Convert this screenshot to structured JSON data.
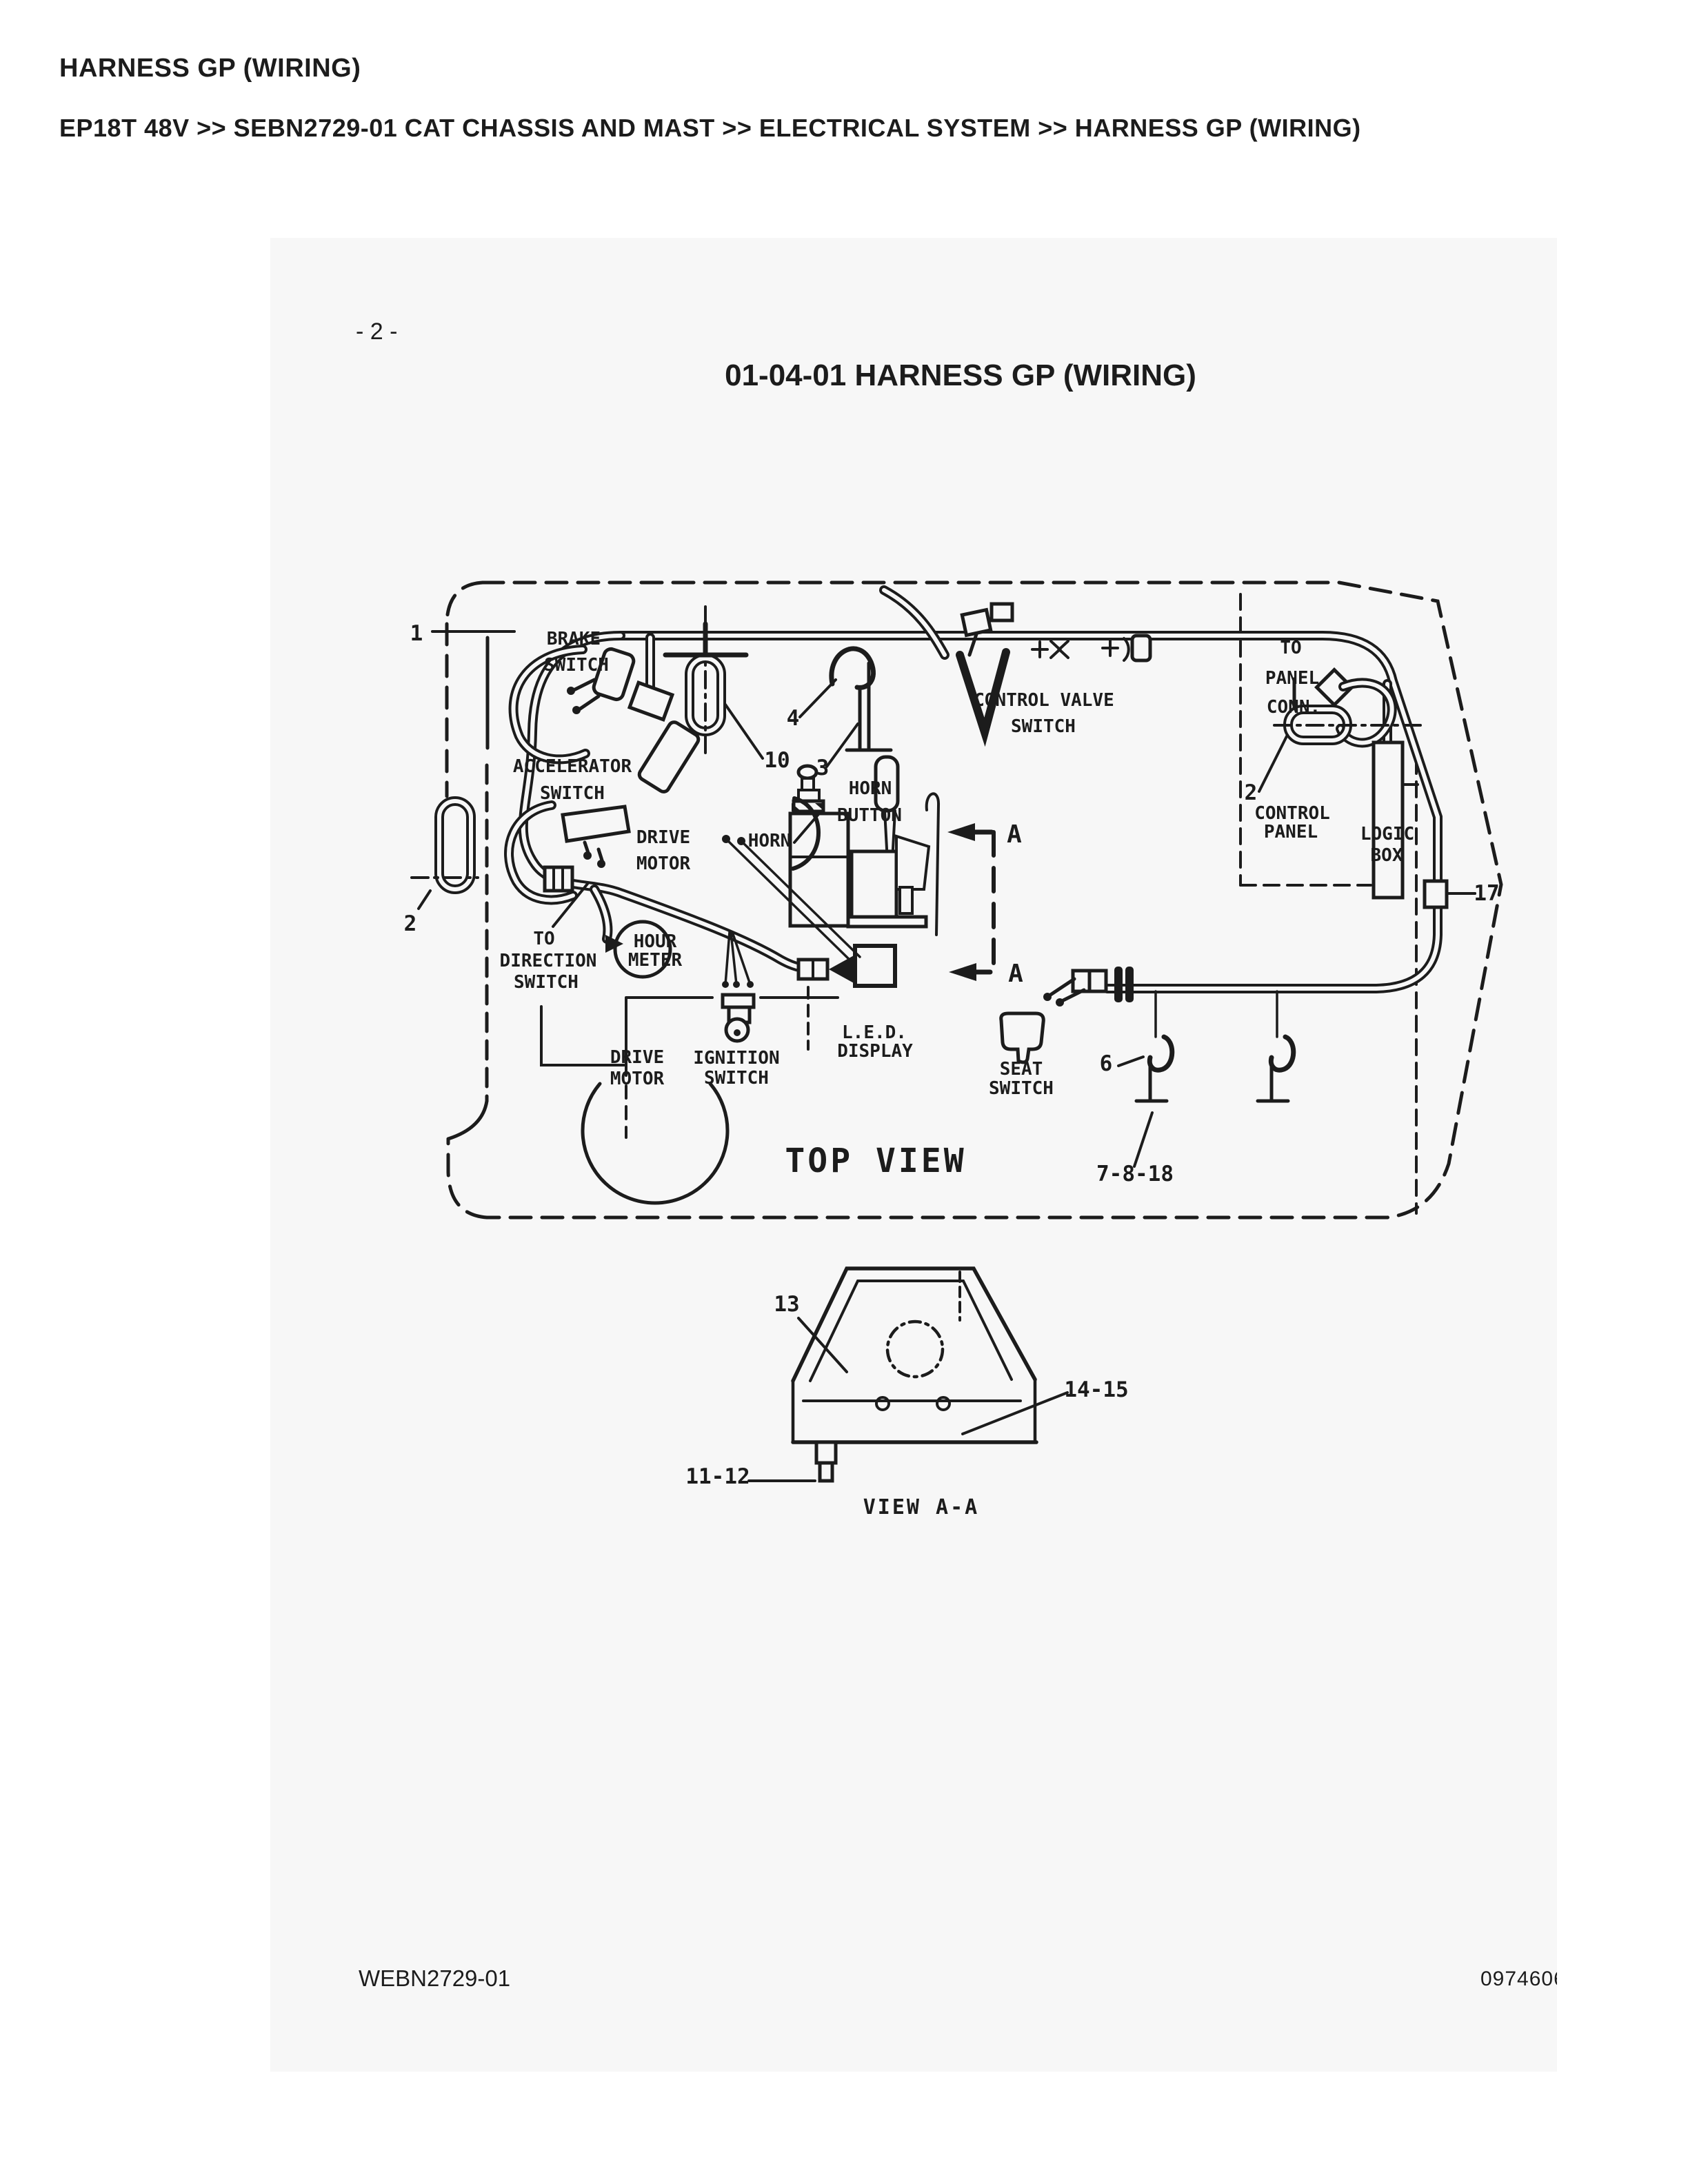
{
  "colors": {
    "ink": "#1c1c1c",
    "page_bg": "#f7f7f7",
    "paper": "#ffffff"
  },
  "header": {
    "title": "HARNESS GP (WIRING)",
    "breadcrumb": "EP18T 48V >> SEBN2729-01 CAT CHASSIS AND MAST >> ELECTRICAL SYSTEM >> HARNESS GP (WIRING)"
  },
  "page": {
    "number": "- 2 -",
    "title": "01-04-01  HARNESS GP (WIRING)",
    "footer_left": "WEBN2729-01",
    "footer_right": "0974606"
  },
  "diagram": {
    "view_label": "TOP VIEW",
    "section_view_label": "VIEW A-A",
    "labels": {
      "brake1": "BRAKE",
      "brake2": "SWITCH",
      "accel1": "ACCELERATOR",
      "accel2": "SWITCH",
      "drive_a1": "DRIVE",
      "drive_a2": "MOTOR",
      "horn": "HORN",
      "horn_btn1": "HORN",
      "horn_btn2": "BUTTON",
      "cvs1": "CONTROL VALVE",
      "cvs2": "SWITCH",
      "tpc1": "TO",
      "tpc2": "PANEL",
      "tpc3": "CONN.",
      "cp1": "CONTROL",
      "cp2": "PANEL",
      "lb1": "LOGIC",
      "lb2": "BOX",
      "tds1": "TO",
      "tds2": "DIRECTION",
      "tds3": "SWITCH",
      "hm1": "HOUR",
      "hm2": "METER",
      "drive_b1": "DRIVE",
      "drive_b2": "MOTOR",
      "ign1": "IGNITION",
      "ign2": "SWITCH",
      "led1": "L.E.D.",
      "led2": "DISPLAY",
      "seat1": "SEAT",
      "seat2": "SWITCH"
    },
    "callouts": {
      "c1": "1",
      "c2_left": "2",
      "c2_right": "2",
      "c3": "3",
      "c4": "4",
      "c6": "6",
      "c10": "10",
      "c17": "17",
      "c7818": "7-8-18",
      "c13": "13",
      "c1415": "14-15",
      "c1112": "11-12",
      "a_upper": "A",
      "a_lower": "A"
    }
  }
}
